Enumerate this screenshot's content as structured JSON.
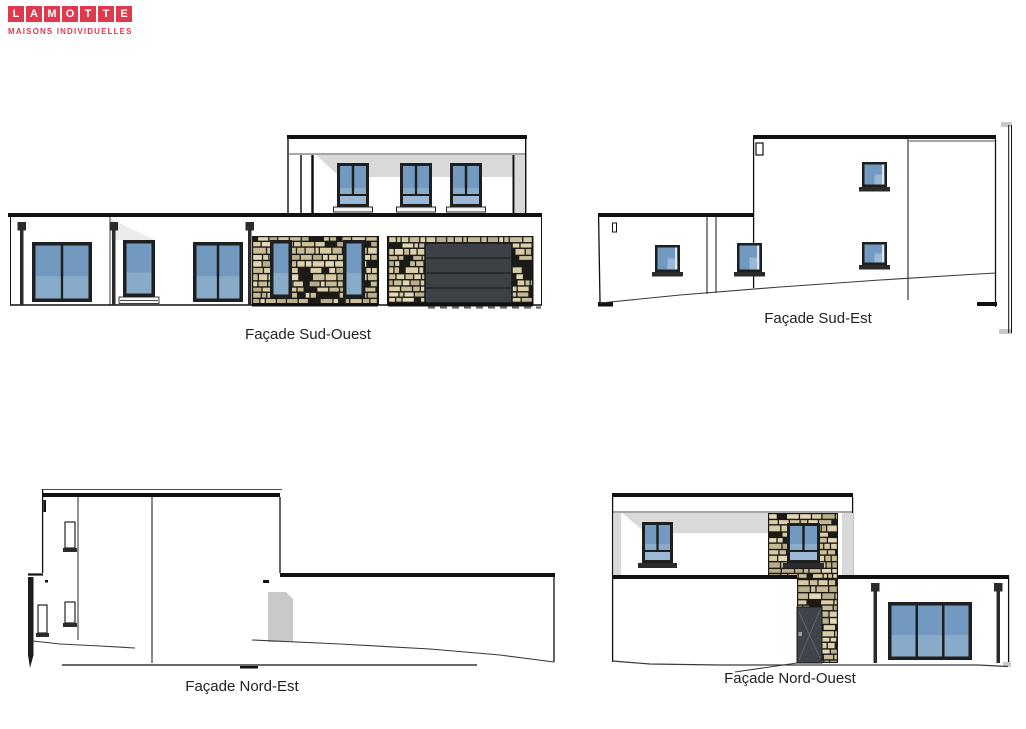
{
  "logo": {
    "letters": [
      "L",
      "A",
      "M",
      "O",
      "T",
      "T",
      "E"
    ],
    "subtitle": "MAISONS INDIVIDUELLES",
    "brand_color": "#e0394e"
  },
  "facades": {
    "sud_ouest": {
      "label": "Façade Sud-Ouest"
    },
    "sud_est": {
      "label": "Façade Sud-Est"
    },
    "nord_est": {
      "label": "Façade Nord-Est"
    },
    "nord_ouest": {
      "label": "Façade Nord-Ouest"
    }
  },
  "colors": {
    "line": "#111111",
    "frame_dark": "#1f1f1f",
    "glass_blue": "#7299bf",
    "glass_blue_light": "#9bb9d6",
    "glass_blue_mid": "#87abc9",
    "roof_shadow_gray": "#d9d9d9",
    "garage_door_gray": "#3b4147",
    "entry_door_gray": "#3e444a",
    "stone_mortar": "#1b1a15",
    "stone_palette": [
      "#d8cca6",
      "#cbbf9a",
      "#e2d8b6",
      "#b9ae8b",
      "#c6b995",
      "#dcd0ab"
    ],
    "terrain_line": "#3a3a3a",
    "label_text": "#222222",
    "silhouette_door_gray": "#c9c9c9"
  }
}
